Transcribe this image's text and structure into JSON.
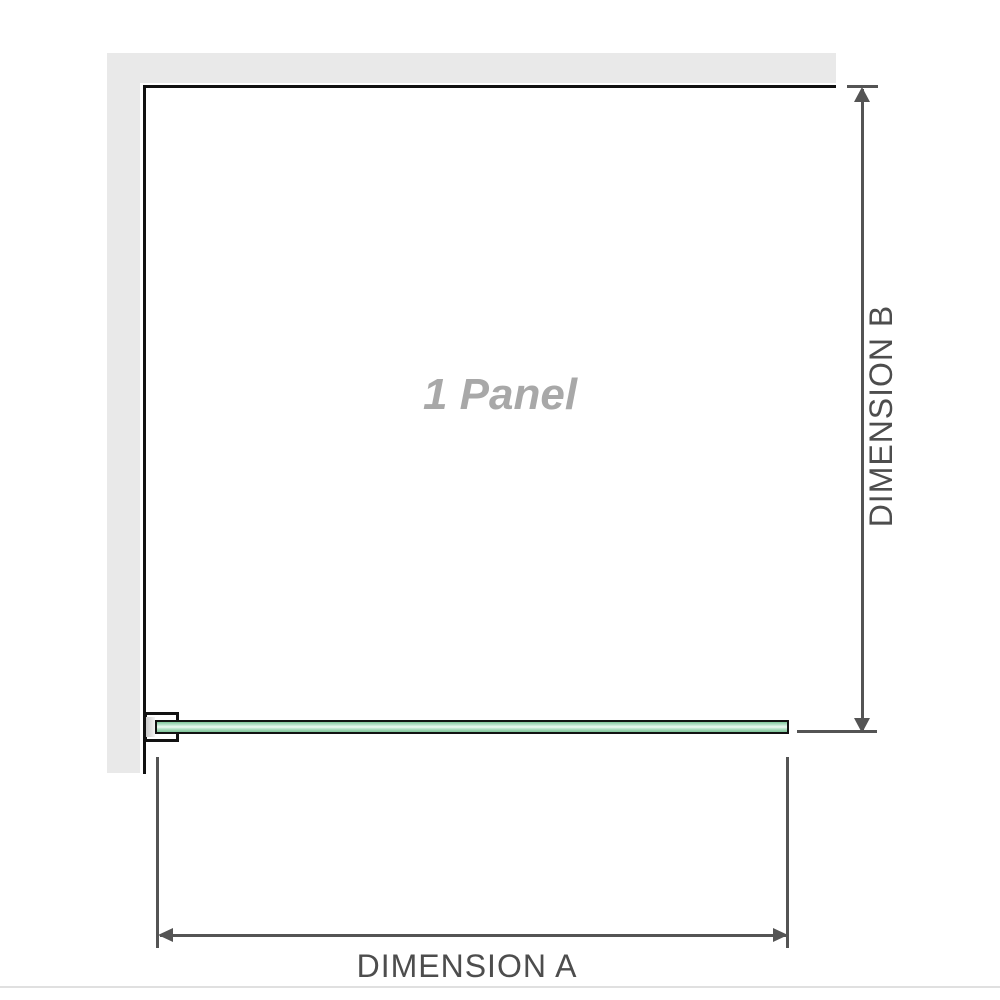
{
  "diagram": {
    "type": "shower-panel-dimension-drawing",
    "panel_label": "1 Panel",
    "dimension_a": {
      "label": "DIMENSION A",
      "axis": "horizontal",
      "measures": "panel width along glass"
    },
    "dimension_b": {
      "label": "DIMENSION B",
      "axis": "vertical",
      "measures": "depth from back wall to glass"
    },
    "icons": [
      "arrow-up-icon",
      "arrow-down-icon",
      "arrow-left-icon",
      "arrow-right-icon"
    ],
    "components": [
      "top-wall",
      "left-wall",
      "panel-outline",
      "glass-panel",
      "wall-bracket"
    ]
  },
  "colors": {
    "background": "#ffffff",
    "wall_gray": "#e9e9e9",
    "outline_black": "#111111",
    "dimension_gray": "#545454",
    "dimension_label_gray": "#4d4d4d",
    "panel_label_gray": "#a8a8a8",
    "glass_green": "#93cfa9",
    "glass_green_light": "#d8f0e2",
    "glass_highlight": "#f0f9f4",
    "bracket_shade_gray": "#cccccc",
    "separator_gray": "#e0e0e0"
  }
}
